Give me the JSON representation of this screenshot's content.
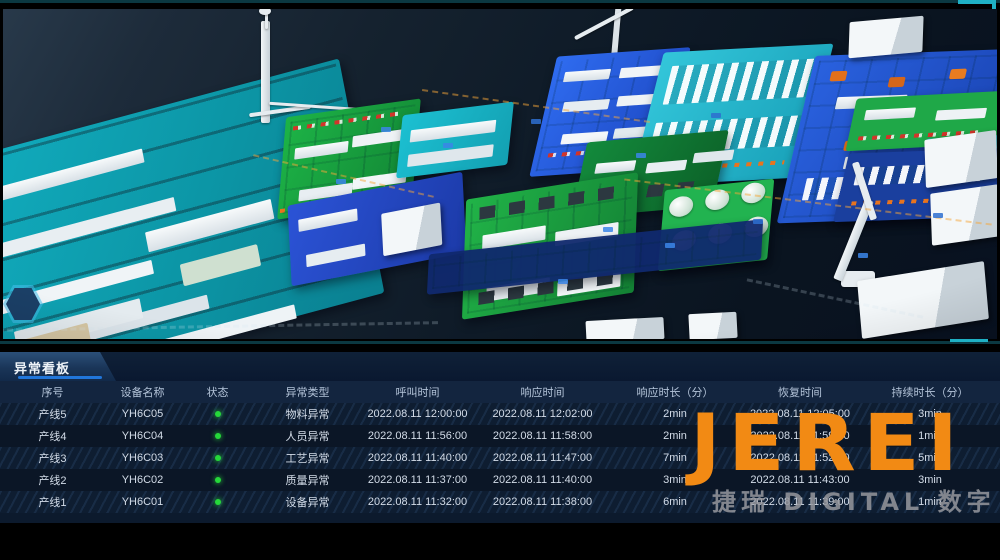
{
  "colors": {
    "accent_blue": "#2176da",
    "status_green": "#25d83a",
    "logo_orange": "#f28a14",
    "plate_teal": "#0da4b4",
    "plate_green": "#1cab42",
    "plate_blue": "#2158d8",
    "plate_cyan": "#23b8cc"
  },
  "panel": {
    "title": "异常看板",
    "columns": [
      "序号",
      "设备名称",
      "状态",
      "异常类型",
      "呼叫时间",
      "响应时间",
      "响应时长（分）",
      "恢复时间",
      "持续时长（分）"
    ],
    "rows": [
      {
        "seq": "产线5",
        "device": "YH6C05",
        "status": "green",
        "type": "物料异常",
        "call_time": "2022.08.11 12:00:00",
        "response_time": "2022.08.11 12:02:00",
        "response_minutes": "2min",
        "recovery_time": "2022.08.11 12:05:00",
        "duration_minutes": "3min"
      },
      {
        "seq": "产线4",
        "device": "YH6C04",
        "status": "green",
        "type": "人员异常",
        "call_time": "2022.08.11 11:56:00",
        "response_time": "2022.08.11 11:58:00",
        "response_minutes": "2min",
        "recovery_time": "2022.08.11 11:59:00",
        "duration_minutes": "1min"
      },
      {
        "seq": "产线3",
        "device": "YH6C03",
        "status": "green",
        "type": "工艺异常",
        "call_time": "2022.08.11 11:40:00",
        "response_time": "2022.08.11 11:47:00",
        "response_minutes": "7min",
        "recovery_time": "2022.08.11 11:52:00",
        "duration_minutes": "5min"
      },
      {
        "seq": "产线2",
        "device": "YH6C02",
        "status": "green",
        "type": "质量异常",
        "call_time": "2022.08.11 11:37:00",
        "response_time": "2022.08.11 11:40:00",
        "response_minutes": "3min",
        "recovery_time": "2022.08.11 11:43:00",
        "duration_minutes": "3min"
      },
      {
        "seq": "产线1",
        "device": "YH6C01",
        "status": "green",
        "type": "设备异常",
        "call_time": "2022.08.11 11:32:00",
        "response_time": "2022.08.11 11:38:00",
        "response_minutes": "6min",
        "recovery_time": "2022.08.11 11:39:00",
        "duration_minutes": "1min"
      }
    ]
  },
  "watermark": {
    "logo": "JEREI",
    "subtext": "捷瑞 DIGITAL 数字"
  }
}
